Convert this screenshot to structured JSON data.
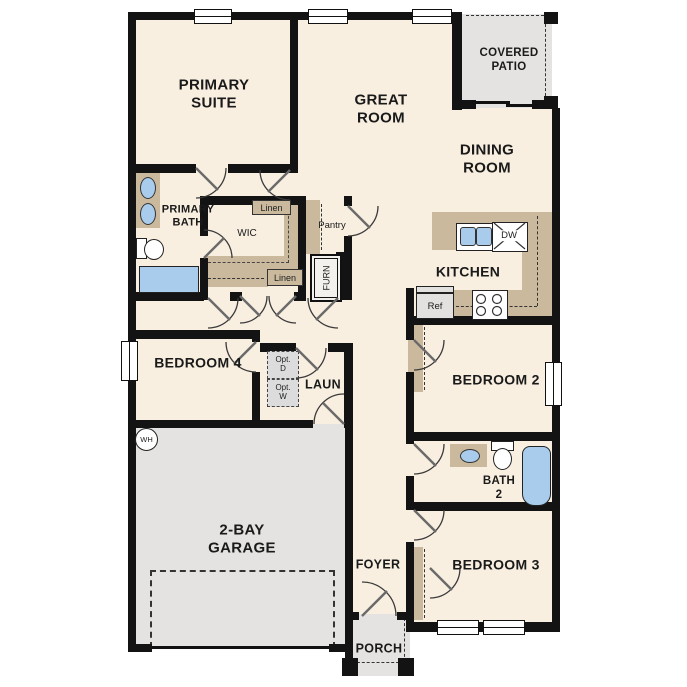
{
  "title": "Single-story floor plan",
  "colors": {
    "floor": "#f8efe1",
    "wall": "#131313",
    "casework": "#cbb99d",
    "concrete": "#e4e3e1",
    "blue": "#a9cbec",
    "opt": "#dcdcdc",
    "text": "#1a1a1a"
  },
  "rooms": {
    "primary_suite": {
      "lines": [
        "PRIMARY",
        "SUITE"
      ]
    },
    "great_room": {
      "lines": [
        "GREAT",
        "ROOM"
      ]
    },
    "covered_patio": {
      "lines": [
        "COVERED",
        "PATIO"
      ]
    },
    "dining_room": {
      "lines": [
        "DINING",
        "ROOM"
      ]
    },
    "kitchen": {
      "lines": [
        "KITCHEN"
      ]
    },
    "primary_bath": {
      "lines": [
        "PRIMARY",
        "BATH"
      ]
    },
    "wic": {
      "lines": [
        "WIC"
      ]
    },
    "pantry": {
      "lines": [
        "Pantry"
      ]
    },
    "bedroom4": {
      "lines": [
        "BEDROOM 4"
      ]
    },
    "laundry": {
      "lines": [
        "LAUN"
      ]
    },
    "garage": {
      "lines": [
        "2-BAY",
        "GARAGE"
      ]
    },
    "foyer": {
      "lines": [
        "FOYER"
      ]
    },
    "porch": {
      "lines": [
        "PORCH"
      ]
    },
    "bedroom2": {
      "lines": [
        "BEDROOM 2"
      ]
    },
    "bath2": {
      "lines": [
        "BATH",
        "2"
      ]
    },
    "bedroom3": {
      "lines": [
        "BEDROOM 3"
      ]
    }
  },
  "fixtures": {
    "linen_top": "Linen",
    "linen_hall": "Linen",
    "furnace": "FURN",
    "water_heater": "WH",
    "refrigerator": "Ref",
    "dishwasher": "DW",
    "opt_dryer": {
      "lines": [
        "Opt.",
        "D"
      ]
    },
    "opt_washer": {
      "lines": [
        "Opt.",
        "W"
      ]
    }
  }
}
